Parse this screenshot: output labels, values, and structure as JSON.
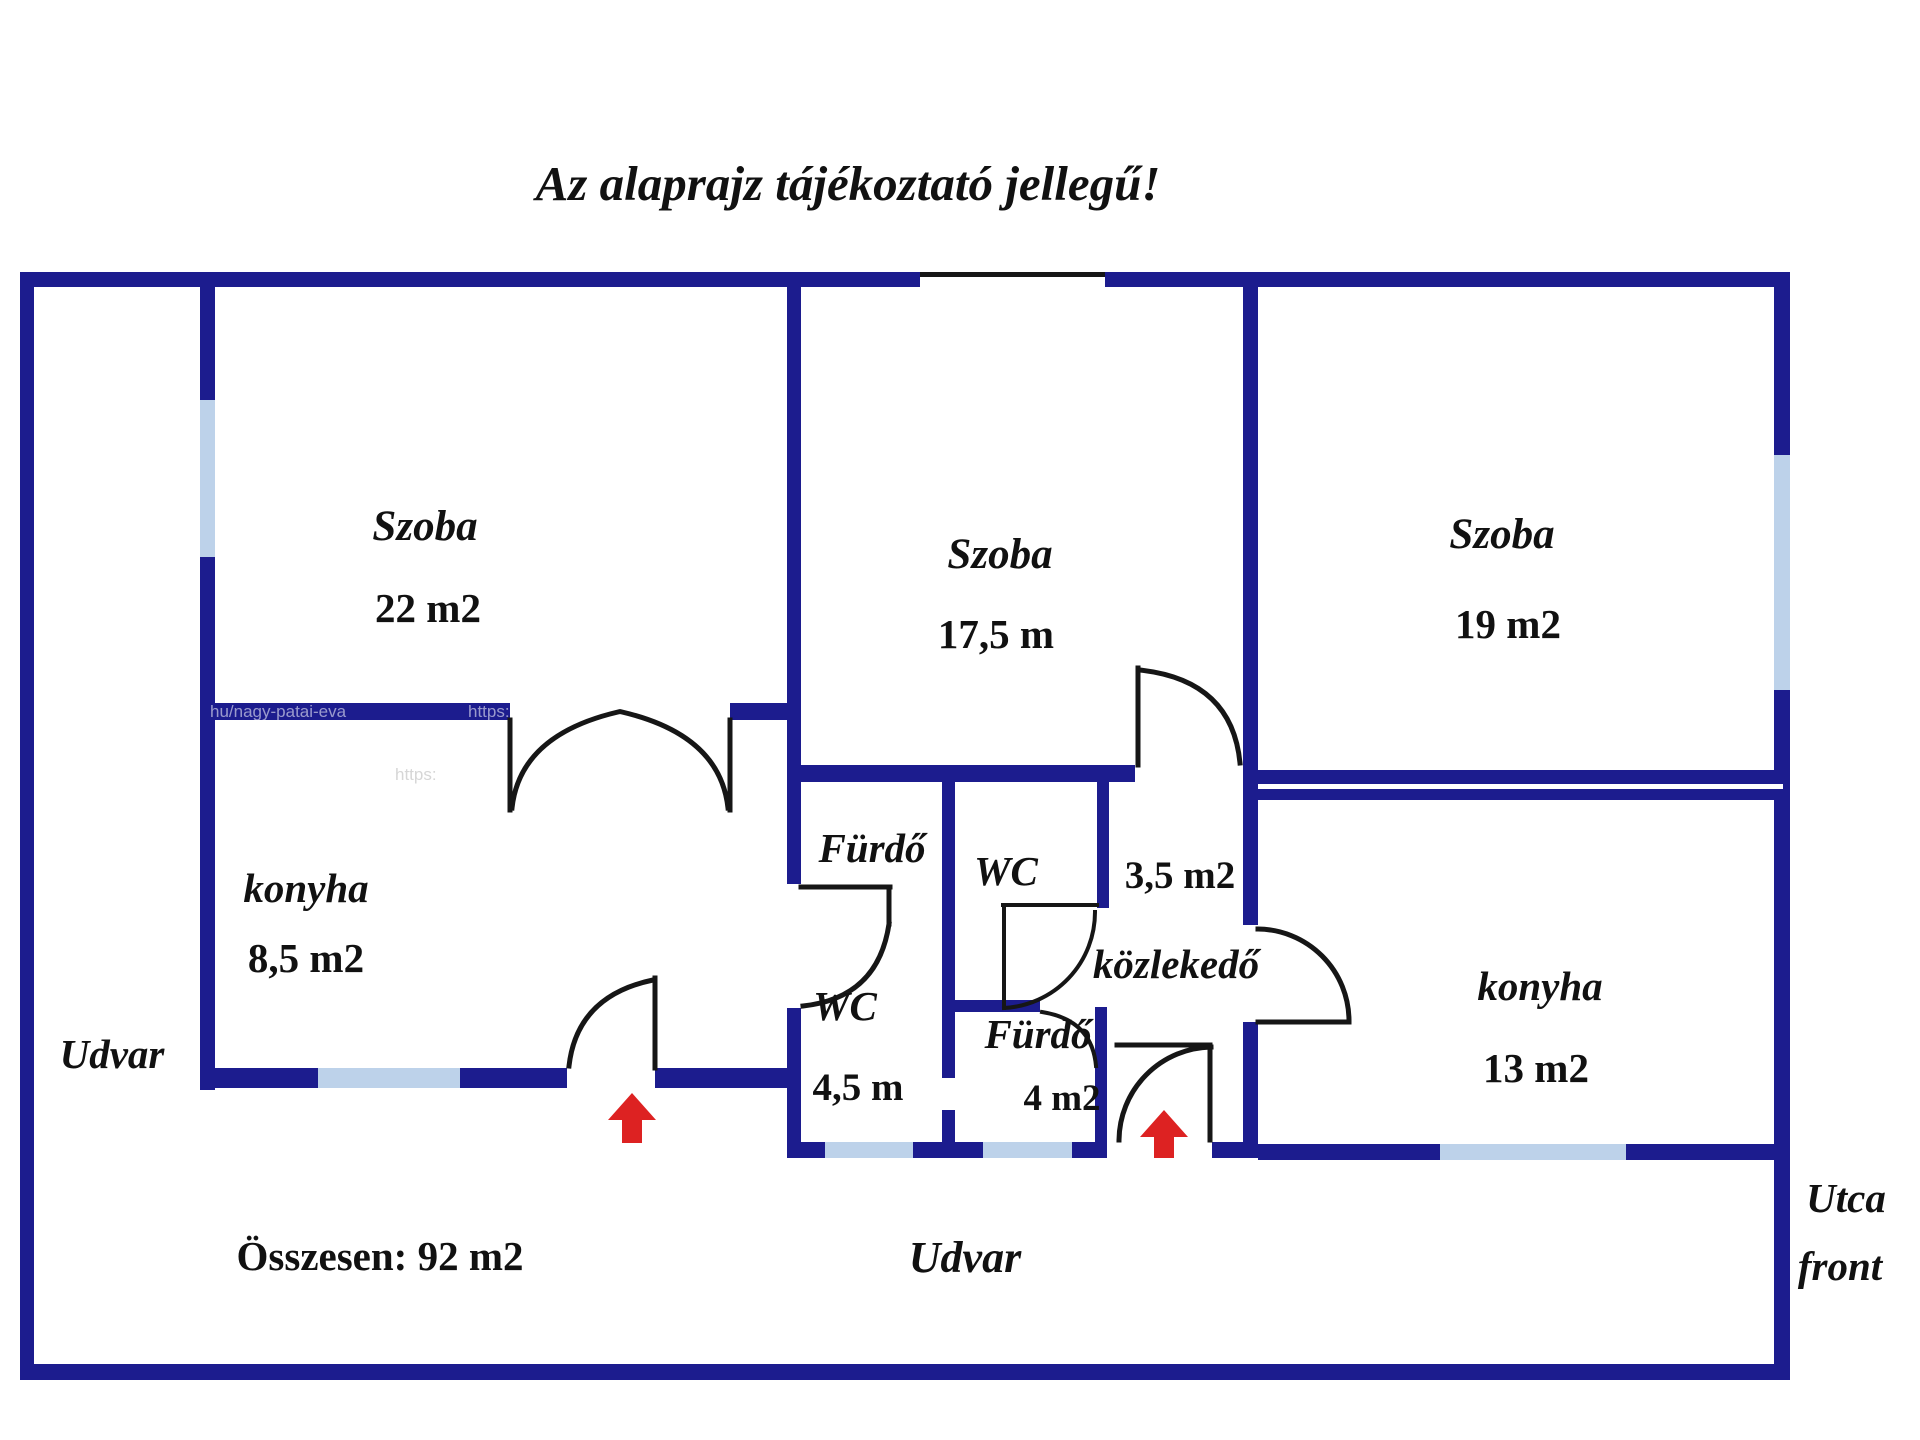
{
  "title": "Az alaprajz tájékoztató jellegű!",
  "colors": {
    "wall_navy": "#1c1c8e",
    "window_blue": "#bdd2ea",
    "door_black": "#161616",
    "arrow_red": "#dd2222",
    "text_ink": "#111111"
  },
  "rooms": {
    "szoba_22": {
      "name": "Szoba",
      "area": "22 m2"
    },
    "szoba_175": {
      "name": "Szoba",
      "area": "17,5 m"
    },
    "szoba_19": {
      "name": "Szoba",
      "area": "19 m2"
    },
    "konyha_85": {
      "name": "konyha",
      "area": "8,5 m2"
    },
    "konyha_13": {
      "name": "konyha",
      "area": "13 m2"
    },
    "furdo_upper": {
      "name": "Fürdő"
    },
    "wc_upper": {
      "name": "WC"
    },
    "corridor_35": {
      "area": "3,5 m2"
    },
    "kozlekedo": {
      "name": "közlekedő"
    },
    "wc_lower": {
      "name": "WC",
      "area": "4,5 m"
    },
    "furdo_lower": {
      "name": "Fürdő",
      "area": "4 m2"
    }
  },
  "outside": {
    "udvar_left": "Udvar",
    "udvar_bottom": "Udvar",
    "utca_line1": "Utca",
    "utca_line2": "front",
    "total": "Összesen: 92 m2"
  },
  "watermarks": {
    "wm1": "hu/nagy-patai-eva",
    "wm2": "https:"
  }
}
